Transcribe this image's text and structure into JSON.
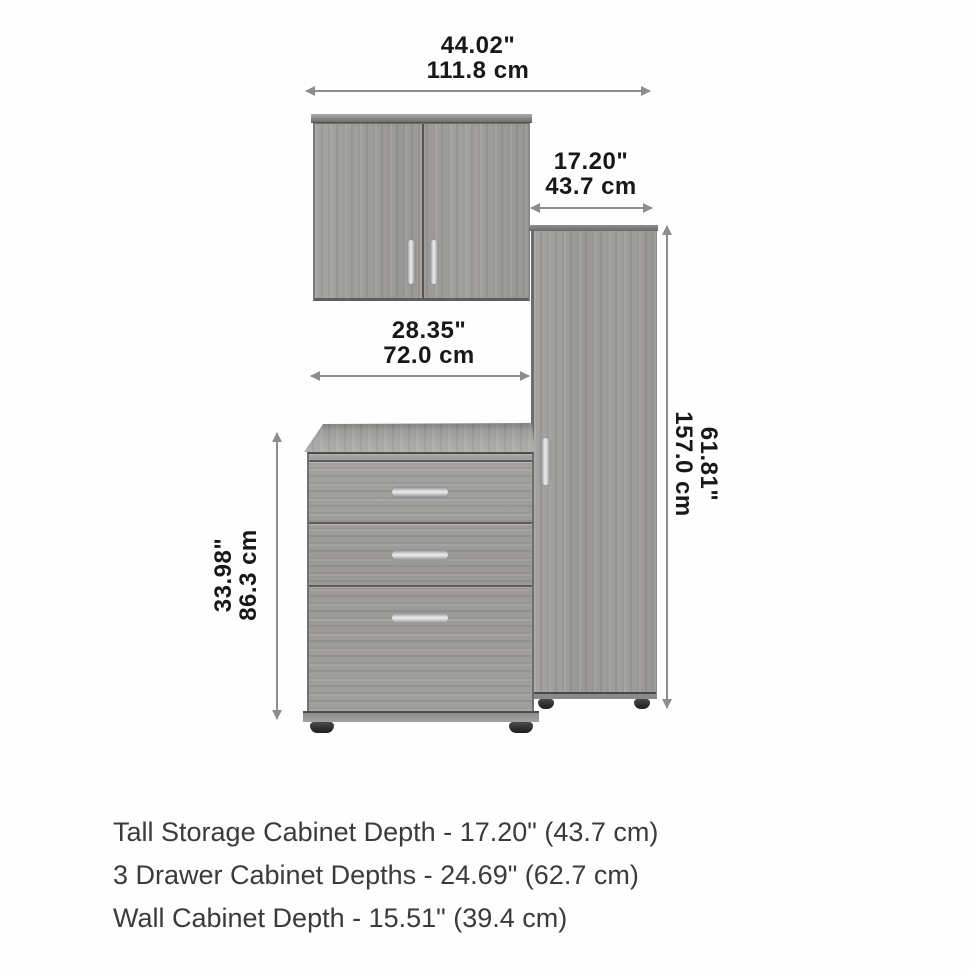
{
  "diagram": {
    "title": "cabinet-set-dimension-diagram",
    "dimensions": {
      "wall_cabinet_width": {
        "inches": "44.02\"",
        "metric": "111.8 cm"
      },
      "tall_cabinet_width": {
        "inches": "17.20\"",
        "metric": "43.7 cm"
      },
      "drawer_cabinet_width": {
        "inches": "28.35\"",
        "metric": "72.0 cm"
      },
      "drawer_cabinet_height": {
        "inches": "33.98\"",
        "metric": "86.3 cm"
      },
      "tall_cabinet_height": {
        "inches": "61.81\"",
        "metric": "157.0 cm"
      }
    },
    "specs": [
      {
        "text": "Tall Storage Cabinet Depth - 17.20\" (43.7 cm)"
      },
      {
        "text": "3 Drawer Cabinet Depths - 24.69\" (62.7 cm)"
      },
      {
        "text": "Wall Cabinet Depth - 15.51\" (39.4 cm)"
      }
    ],
    "colors": {
      "wood": "#9f9e9c",
      "wood_edge_dark": "#5f5e5d",
      "handle_silver": "#cccccc",
      "arrow": "#8d8d8d",
      "dimension_text": "#181818",
      "spec_text": "#3b3b3b",
      "feet": "#2e2e2e",
      "background": "#fefefe"
    }
  }
}
